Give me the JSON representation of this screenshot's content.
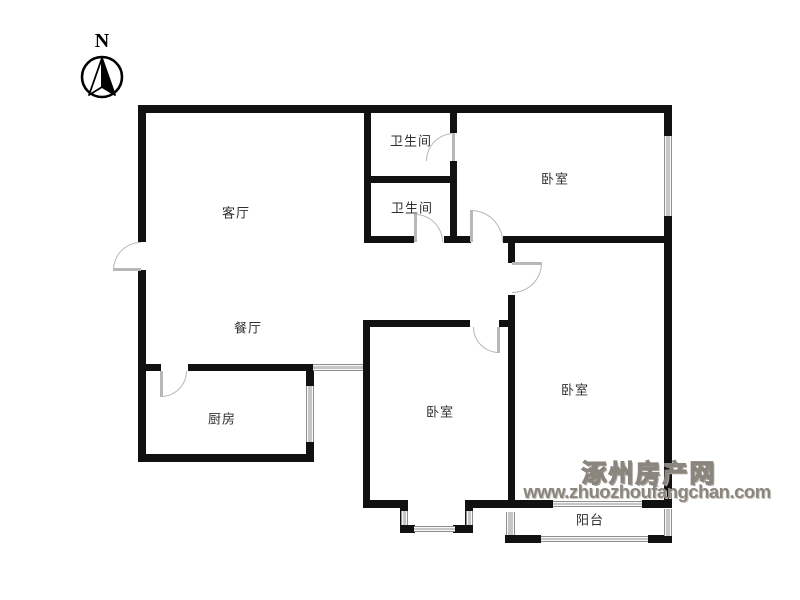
{
  "compass": {
    "label": "N"
  },
  "watermark": {
    "line1": "涿州房产网",
    "line2": "www.zhuozhoufangchan.com",
    "color": "#8a857d"
  },
  "rooms": [
    {
      "id": "living-room",
      "label": "客厅",
      "cx": 236,
      "cy": 212
    },
    {
      "id": "dining-room",
      "label": "餐厅",
      "cx": 248,
      "cy": 327
    },
    {
      "id": "kitchen",
      "label": "厨房",
      "cx": 222,
      "cy": 418
    },
    {
      "id": "bathroom-1",
      "label": "卫生间",
      "cx": 411,
      "cy": 140
    },
    {
      "id": "bathroom-2",
      "label": "卫生间",
      "cx": 412,
      "cy": 207
    },
    {
      "id": "bedroom-north",
      "label": "卧室",
      "cx": 555,
      "cy": 178
    },
    {
      "id": "bedroom-middle",
      "label": "卧室",
      "cx": 440,
      "cy": 411
    },
    {
      "id": "bedroom-south",
      "label": "卧室",
      "cx": 575,
      "cy": 389
    },
    {
      "id": "balcony",
      "label": "阳台",
      "cx": 590,
      "cy": 519
    }
  ],
  "plan": {
    "colors": {
      "wall": "#111111",
      "door_arc": "#b7b7b7",
      "window_frame": "#8f8f8f",
      "room_label": "#2f2f2f",
      "watermark": "#8a857d"
    },
    "walls": [
      [
        138,
        105,
        534,
        8
      ],
      [
        138,
        105,
        8,
        137
      ],
      [
        138,
        270,
        8,
        192
      ],
      [
        138,
        454,
        176,
        8
      ],
      [
        306,
        364,
        8,
        98
      ],
      [
        138,
        364,
        23,
        7
      ],
      [
        188,
        364,
        118,
        7
      ],
      [
        364,
        105,
        7,
        138
      ],
      [
        364,
        176,
        93,
        7
      ],
      [
        450,
        105,
        7,
        28
      ],
      [
        450,
        161,
        7,
        82
      ],
      [
        364,
        236,
        50,
        7
      ],
      [
        444,
        236,
        27,
        7
      ],
      [
        503,
        236,
        169,
        7
      ],
      [
        508,
        243,
        7,
        20
      ],
      [
        508,
        295,
        7,
        212
      ],
      [
        363,
        320,
        107,
        7
      ],
      [
        499,
        320,
        16,
        7
      ],
      [
        363,
        327,
        7,
        181
      ],
      [
        363,
        500,
        45,
        8
      ],
      [
        400,
        500,
        8,
        33
      ],
      [
        400,
        525,
        15,
        8
      ],
      [
        453,
        525,
        20,
        8
      ],
      [
        465,
        500,
        8,
        33
      ],
      [
        465,
        500,
        50,
        8
      ],
      [
        505,
        500,
        48,
        8
      ],
      [
        642,
        500,
        30,
        8
      ],
      [
        505,
        535,
        36,
        8
      ],
      [
        648,
        535,
        24,
        8
      ],
      [
        664,
        105,
        8,
        402
      ]
    ],
    "windows": [
      [
        664,
        136,
        8,
        80
      ],
      [
        306,
        386,
        8,
        56
      ],
      [
        313,
        364,
        50,
        7
      ],
      [
        414,
        526,
        41,
        6
      ],
      [
        401,
        511,
        7,
        14
      ],
      [
        466,
        511,
        7,
        14
      ],
      [
        553,
        501,
        89,
        6
      ],
      [
        541,
        536,
        107,
        6
      ],
      [
        506,
        512,
        9,
        23
      ],
      [
        664,
        509,
        8,
        27
      ]
    ],
    "doors": [
      {
        "id": "entry-door",
        "box": [
          113,
          242,
          28,
          28
        ],
        "corner": "tl",
        "leaf": [
          113,
          268,
          28,
          3
        ]
      },
      {
        "id": "kitchen-door",
        "box": [
          161,
          371,
          26,
          26
        ],
        "corner": "br",
        "leaf": [
          160,
          371,
          3,
          26
        ]
      },
      {
        "id": "bathroom-2-door",
        "box": [
          415,
          214,
          28,
          28
        ],
        "corner": "tr",
        "leaf": [
          414,
          214,
          3,
          28
        ]
      },
      {
        "id": "bedroom-north-door",
        "box": [
          471,
          210,
          32,
          32
        ],
        "corner": "tr",
        "leaf": [
          470,
          210,
          3,
          32
        ]
      },
      {
        "id": "bathroom-1-door",
        "box": [
          426,
          133,
          28,
          28
        ],
        "corner": "tl",
        "leaf": [
          452,
          133,
          3,
          28
        ]
      },
      {
        "id": "bedroom-middle-door",
        "box": [
          473,
          327,
          26,
          26
        ],
        "corner": "bl",
        "leaf": [
          497,
          327,
          3,
          26
        ]
      },
      {
        "id": "bedroom-south-door",
        "box": [
          512,
          263,
          30,
          30
        ],
        "corner": "br",
        "leaf": [
          512,
          262,
          30,
          3
        ]
      }
    ]
  }
}
